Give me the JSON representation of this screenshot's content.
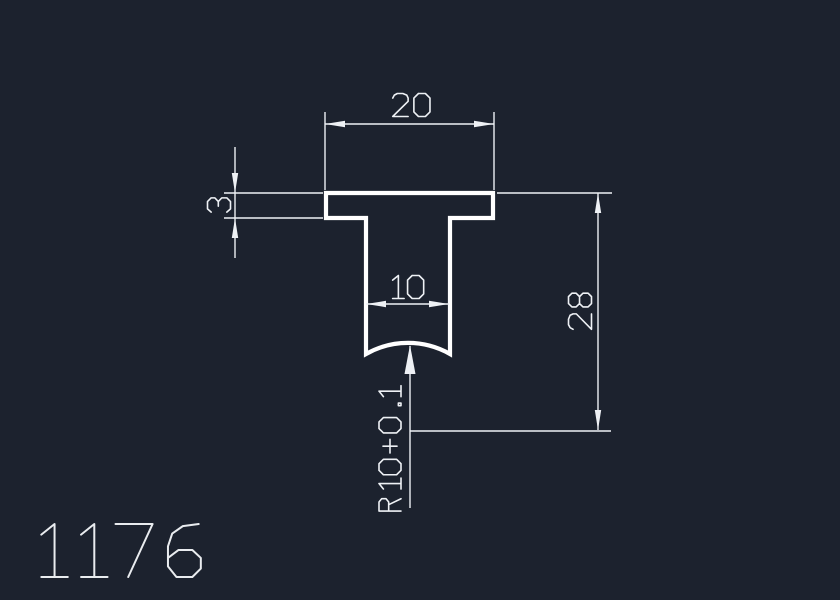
{
  "drawing": {
    "part_number": "1176",
    "colors": {
      "background": "#1c222e",
      "profile_line": "#ffffff",
      "dimension_line": "#eef1f5",
      "part_number_text": "#e9ecef"
    },
    "dimensions": [
      {
        "name": "top-width",
        "label": "20",
        "orientation": "horizontal"
      },
      {
        "name": "flange-thickness",
        "label": "3",
        "orientation": "vertical"
      },
      {
        "name": "stem-width",
        "label": "10",
        "orientation": "horizontal"
      },
      {
        "name": "overall-height",
        "label": "28",
        "orientation": "vertical"
      },
      {
        "name": "groove-radius",
        "label": "R10+0.1",
        "orientation": "vertical-leader"
      }
    ]
  }
}
